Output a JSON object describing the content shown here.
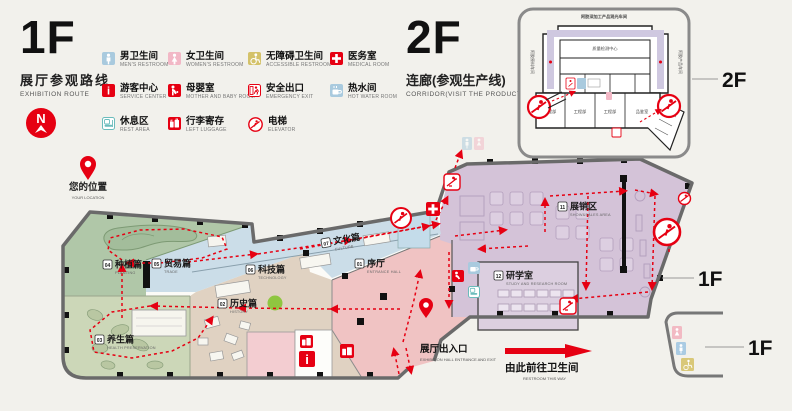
{
  "page": {
    "bg": "#f2f1ec",
    "accent_red": "#e60012"
  },
  "header_1f": {
    "title": "1F",
    "subtitle_zh": "展厅参观路线",
    "subtitle_en": "EXHIBITION ROUTE"
  },
  "header_2f": {
    "title": "2F",
    "subtitle_zh": "连廊(参观生产线)",
    "subtitle_en": "CORRIDOR(VISIT THE PRODUCTION LINE)"
  },
  "compass": {
    "n": "N"
  },
  "legend": {
    "items": [
      {
        "zh": "男卫生间",
        "en": "MEN'S RESTROOM",
        "color": "#a9cade"
      },
      {
        "zh": "女卫生间",
        "en": "WOMEN'S RESTROOM",
        "color": "#f2b8c6"
      },
      {
        "zh": "无障碍卫生间",
        "en": "ACCESSIBLE RESTROOM",
        "color": "#d4c26a"
      },
      {
        "zh": "医务室",
        "en": "MEDICAL ROOM",
        "color": "#e60012"
      },
      {
        "zh": "游客中心",
        "en": "SERVICE CENTER",
        "color": "#e60012"
      },
      {
        "zh": "母婴室",
        "en": "MOTHER AND BABY ROOM",
        "color": "#e60012"
      },
      {
        "zh": "安全出口",
        "en": "EMERGENCY EXIT",
        "color": "#e60012"
      },
      {
        "zh": "热水间",
        "en": "HOT WATER ROOM",
        "color": "#a9cade"
      },
      {
        "zh": "休息区",
        "en": "REST AREA",
        "color": "#6bbcbc"
      },
      {
        "zh": "行李寄存",
        "en": "LEFT LUGGAGE",
        "color": "#e60012"
      },
      {
        "zh": "电梯",
        "en": "ELEVATOR",
        "color": "#e60012"
      }
    ]
  },
  "zones": [
    {
      "num": "01",
      "zh": "序厅",
      "en": "ENTRANCE HALL"
    },
    {
      "num": "07",
      "zh": "文化篇",
      "en": "CULTURE"
    },
    {
      "num": "02",
      "zh": "历史篇",
      "en": "HISTORY"
    },
    {
      "num": "03",
      "zh": "养生篇",
      "en": "HEALTH PRESERVATION"
    },
    {
      "num": "04",
      "zh": "种植篇",
      "en": "PLANTING"
    },
    {
      "num": "05",
      "zh": "贸易篇",
      "en": "TRADE"
    },
    {
      "num": "06",
      "zh": "科技篇",
      "en": "TECHNOLOGY"
    },
    {
      "num": "11",
      "zh": "展销区",
      "en": "SHOW&SALES AREA"
    },
    {
      "num": "12",
      "zh": "研学室",
      "en": "STUDY AND RESEARCH ROOM"
    }
  ],
  "map": {
    "you_zh": "您的位置",
    "you_en": "YOUR LOCATION",
    "entrance_zh": "展厅出入口",
    "entrance_en": "EXHIBITION HALL ENTRANCE AND EXIT",
    "restroom_zh": "由此前往卫生间",
    "restroom_en": "RESTROOM THIS WAY"
  },
  "floor_tags": {
    "inset": "2F",
    "map_tip": "1F",
    "restroom": "1F"
  },
  "inset_2f": {
    "title": "阿胶深加工产品观光车间",
    "center_room": "质量检测中心",
    "left_wing": "阿胶原料车间",
    "right_wing": "阿胶产品车间",
    "rooms": [
      "工程部",
      "工程部",
      "工程部",
      "品鉴室"
    ]
  }
}
